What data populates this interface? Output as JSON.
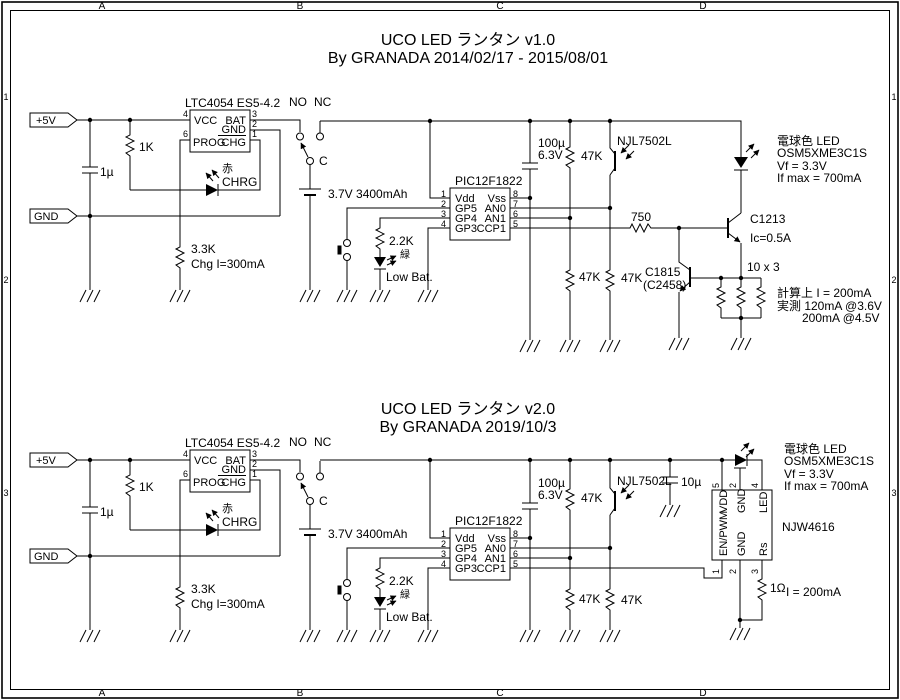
{
  "frame": {
    "columns": [
      "A",
      "B",
      "C",
      "D"
    ],
    "rows": [
      "1",
      "2",
      "3"
    ]
  },
  "v1": {
    "title": "UCO LED ランタン v1.0",
    "byline": "By GRANADA 2014/02/17 - 2015/08/01",
    "conn_5v": "+5V",
    "conn_gnd": "GND",
    "c1": "1µ",
    "r1": "1K",
    "r2": "3.3K",
    "chg_note": "Chg I=300mA",
    "ltc": {
      "label": "LTC4054 ES5-4.2",
      "vcc": "VCC",
      "bat": "BAT",
      "gnd": "GND",
      "prog": "PROG",
      "chg": "CHG",
      "p4": "4",
      "p6": "6",
      "p3": "3",
      "p2": "2",
      "p1": "1"
    },
    "led_red": "赤",
    "led_red_label": "CHRG",
    "sw": {
      "no": "NO",
      "nc": "NC",
      "c": "C"
    },
    "battery": "3.7V 3400mAh",
    "pic": {
      "label": "PIC12F1822",
      "l": [
        "Vdd",
        "GP5",
        "GP4",
        "GP3"
      ],
      "r": [
        "Vss",
        "AN0",
        "AN1",
        "CCP1"
      ],
      "pl": [
        "1",
        "2",
        "3",
        "4"
      ],
      "pr": [
        "8",
        "7",
        "6",
        "5"
      ]
    },
    "r3": "2.2K",
    "led_green": "緑",
    "led_green_label": "Low Bat.",
    "c2": "100µ",
    "c2v": "6.3V",
    "r4": "47K",
    "r5": "47K",
    "r6": "47K",
    "photo": "NJL7502L",
    "r7": "750",
    "q1": "C1213",
    "q1_note": "Ic=0.5A",
    "q2": "C1815",
    "q2_alt": "(C2458)",
    "r8": "10 x 3",
    "led_info": [
      "電球色 LED",
      "OSM5XME3C1S",
      "Vf = 3.3V",
      "If max = 700mA"
    ],
    "notes": [
      "計算上 I = 200mA",
      "実測 120mA @3.6V",
      "200mA @4.5V"
    ]
  },
  "v2": {
    "title": "UCO LED ランタン v2.0",
    "byline": "By GRANADA 2019/10/3",
    "conn_5v": "+5V",
    "conn_gnd": "GND",
    "c1": "1µ",
    "r1": "1K",
    "r2": "3.3K",
    "chg_note": "Chg I=300mA",
    "ltc": {
      "label": "LTC4054 ES5-4.2",
      "vcc": "VCC",
      "bat": "BAT",
      "gnd": "GND",
      "prog": "PROG",
      "chg": "CHG",
      "p4": "4",
      "p6": "6",
      "p3": "3",
      "p2": "2",
      "p1": "1"
    },
    "led_red": "赤",
    "led_red_label": "CHRG",
    "sw": {
      "no": "NO",
      "nc": "NC",
      "c": "C"
    },
    "battery": "3.7V 3400mAh",
    "pic": {
      "label": "PIC12F1822",
      "l": [
        "Vdd",
        "GP5",
        "GP4",
        "GP3"
      ],
      "r": [
        "Vss",
        "AN0",
        "AN1",
        "CCP1"
      ],
      "pl": [
        "1",
        "2",
        "3",
        "4"
      ],
      "pr": [
        "8",
        "7",
        "6",
        "5"
      ]
    },
    "r3": "2.2K",
    "led_green": "緑",
    "led_green_label": "Low Bat.",
    "c2": "100µ",
    "c2v": "6.3V",
    "r4": "47K",
    "r5": "47K",
    "r6": "47K",
    "photo": "NJL7502L",
    "c3": "10µ",
    "drv": {
      "label": "NJW4616",
      "vdd": "VDD",
      "gnd_top": "GND",
      "led": "LED",
      "en": "EN/PWM",
      "gnd_bot": "GND",
      "rs": "Rs",
      "p5": "5",
      "p2t": "2",
      "p4": "4",
      "p1": "1",
      "p2b": "2",
      "p3": "3"
    },
    "r9": "1Ω",
    "sense_note": "I = 200mA",
    "led_info": [
      "電球色 LED",
      "OSM5XME3C1S",
      "Vf = 3.3V",
      "If max = 700mA"
    ]
  }
}
